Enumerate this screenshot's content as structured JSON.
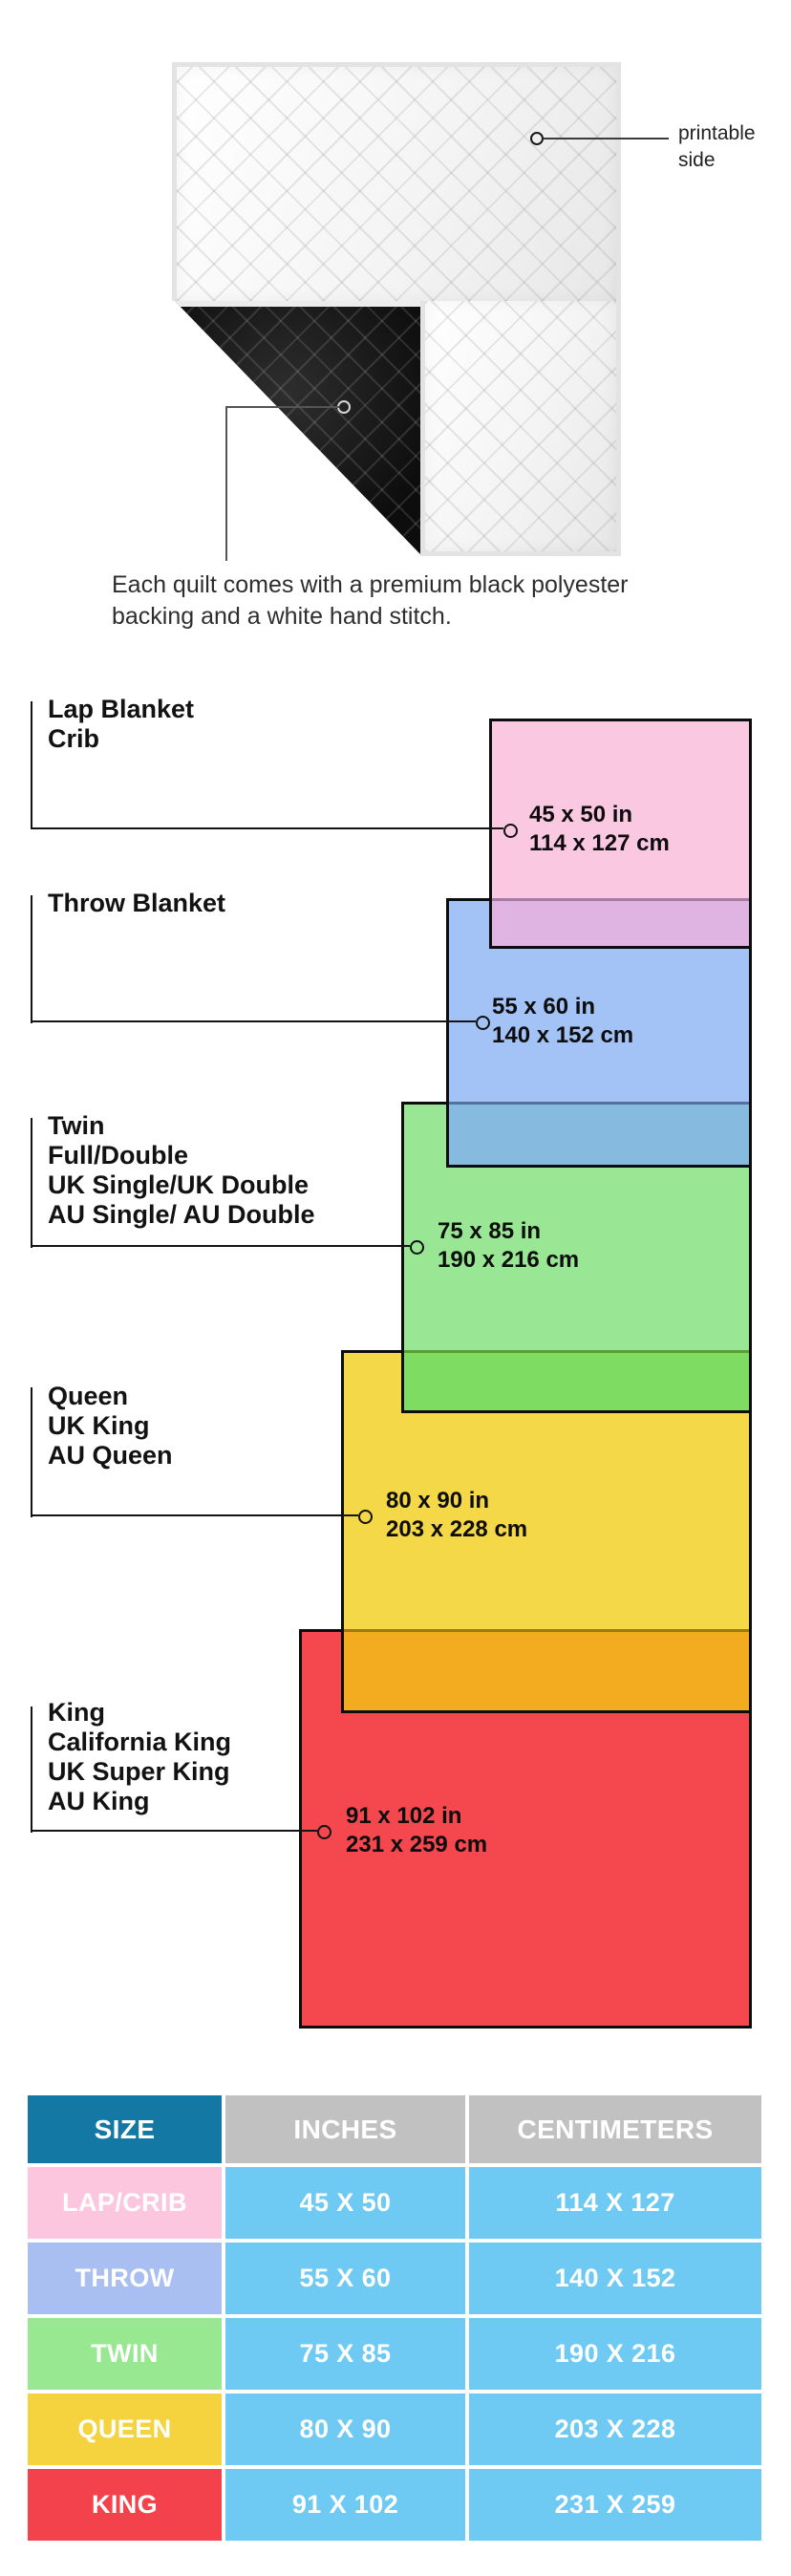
{
  "quilt_note": {
    "printable_label": [
      "printable",
      "side"
    ],
    "caption": [
      "Each quilt comes with a premium black polyester",
      "backing and a white hand stitch."
    ]
  },
  "size_diagram": {
    "items": [
      {
        "name": "lap-crib",
        "labels": [
          "Lap Blanket",
          "Crib"
        ],
        "inches": "45 x 50 in",
        "centimeters": "114 x 127 cm",
        "color": "#fbc8e1"
      },
      {
        "name": "throw",
        "labels": [
          "Throw Blanket"
        ],
        "inches": "55 x 60 in",
        "centimeters": "140 x 152 cm",
        "color": "#a3c2f6"
      },
      {
        "name": "twin",
        "labels": [
          "Twin",
          "Full/Double",
          "UK Single/UK Double",
          "AU Single/ AU Double"
        ],
        "inches": "75 x 85 in",
        "centimeters": "190 x 216 cm",
        "color": "#99e795"
      },
      {
        "name": "queen",
        "labels": [
          "Queen",
          "UK King",
          "AU Queen"
        ],
        "inches": "80 x 90 in",
        "centimeters": "203 x 228 cm",
        "color": "#f5d847"
      },
      {
        "name": "king",
        "labels": [
          "King",
          "California King",
          "UK Super King",
          "AU King"
        ],
        "inches": "91 x 102 in",
        "centimeters": "231 x 259 cm",
        "color": "#f4484e"
      }
    ]
  },
  "size_table": {
    "headers": [
      "SIZE",
      "INCHES",
      "CENTIMETERS"
    ],
    "header_colors": {
      "size_bg": "#1478a5",
      "measure_bg": "#c1c1c1"
    },
    "data_cell_color": "#6fcaf3",
    "rows": [
      {
        "size": "LAP/CRIB",
        "inches": "45 X 50",
        "centimeters": "114 X 127",
        "color": "#fcc7de"
      },
      {
        "size": "THROW",
        "inches": "55 X 60",
        "centimeters": "140 X 152",
        "color": "#a9bff2"
      },
      {
        "size": "TWIN",
        "inches": "75 X 85",
        "centimeters": "190 X 216",
        "color": "#98e791"
      },
      {
        "size": "QUEEN",
        "inches": "80 X 90",
        "centimeters": "203 X 228",
        "color": "#f4d33e"
      },
      {
        "size": "KING",
        "inches": "91 X 102",
        "centimeters": "231 X 259",
        "color": "#f4424c"
      }
    ]
  }
}
